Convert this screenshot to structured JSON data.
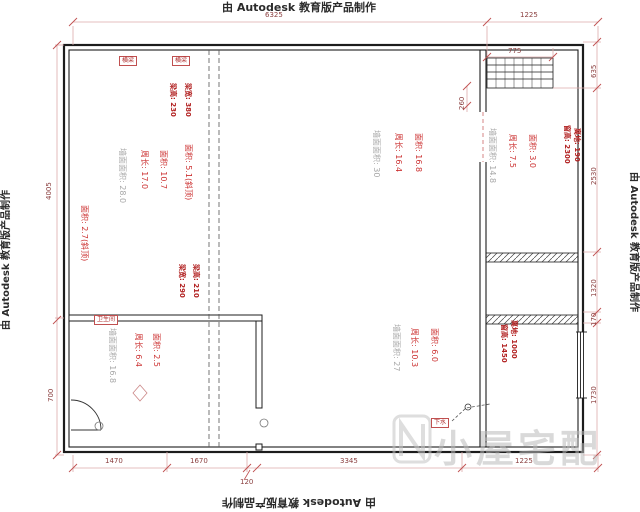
{
  "watermark": {
    "autodesk": "由 Autodesk 教育版产品制作",
    "logo_text": "小屋宅配"
  },
  "dims": {
    "top": [
      "6325",
      "1225"
    ],
    "top_window_width": "775",
    "top_window_depth": "260",
    "right": [
      "635",
      "2530",
      "1320",
      "170",
      "1730"
    ],
    "left": [
      "4005",
      "700"
    ],
    "bottom": [
      "1470",
      "1670",
      "3345",
      "1225"
    ],
    "bottom_gap": "120"
  },
  "rooms": {
    "left": {
      "area_sloped": "面积: 5.1(斜顶)",
      "area": "面积: 10.7",
      "perimeter": "周长: 17.0",
      "wall": "墙面面积: 28.0",
      "area_sloped2": "面积: 2.7(斜顶)"
    },
    "center": {
      "area": "面积: 16.8",
      "perimeter": "周长: 16.4",
      "wall": "墙面面积: 30"
    },
    "right_top": {
      "area": "面积: 3.0",
      "perimeter": "周长: 7.5",
      "wall": "墙面面积: 14.8"
    },
    "bathroom": {
      "area": "面积: 2.5",
      "perimeter": "周长: 6.4",
      "wall": "墙面面积: 16.8",
      "tag": "卫生间"
    },
    "right_bottom": {
      "area": "面积: 6.0",
      "perimeter": "周长: 10.3",
      "wall": "墙面面积: 27"
    }
  },
  "beams": {
    "tag1": "横梁",
    "tag2": "横梁",
    "b1_a": "梁高: 230",
    "b1_b": "梁宽: 380",
    "b2_a": "梁宽: 290",
    "b2_b": "梁高: 210"
  },
  "windows": {
    "w1_height": "窗高: 2300",
    "w1_offset": "离地: 190",
    "w2_height": "窗高: 1450",
    "w2_offset": "离地: 1000"
  },
  "labels": {
    "drain": "下水"
  },
  "colors": {
    "dim_line": "#dcaaaa",
    "dim_tick": "#c05050",
    "dim_text": "#8b4040",
    "annotation_red": "#cc3333",
    "annotation_grey": "#a8a8a8",
    "bold_red": "#b22222",
    "wall": "#1c1c1c"
  }
}
